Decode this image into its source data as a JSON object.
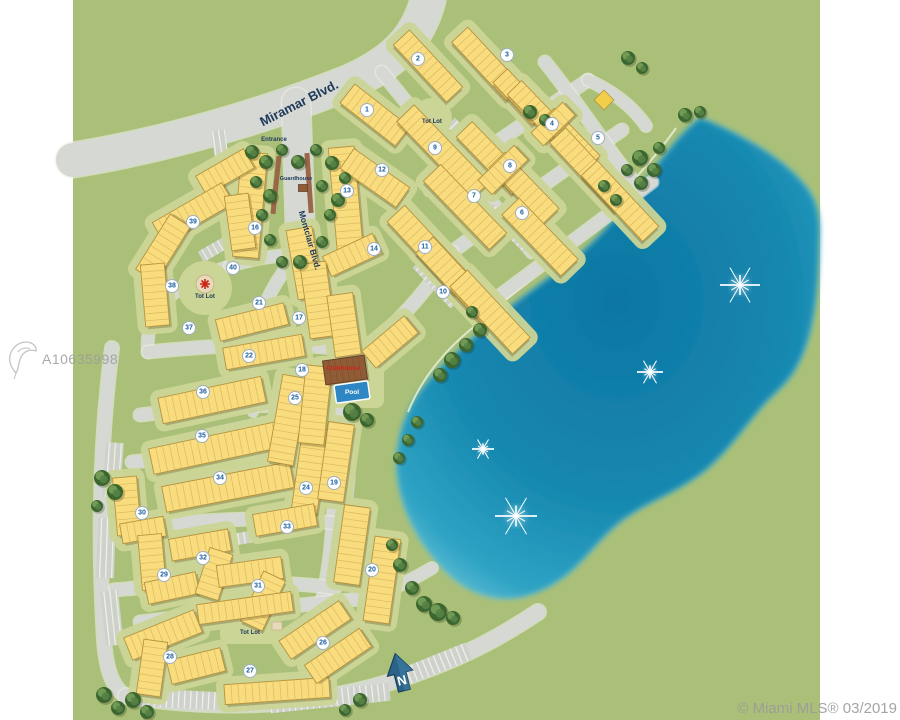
{
  "watermark": {
    "id": "A10635998"
  },
  "credit": {
    "text": "© Miami MLS® 03/2019"
  },
  "map": {
    "colors": {
      "white": "#ffffff",
      "green": "#aac079",
      "road": "#d6d8d3",
      "roadEdge": "#eceee8",
      "lawn": "#cbd596",
      "bldg": "#f9dc7e",
      "bldgLine": "#b5933e",
      "unitLine": "#dcba60",
      "shadow": "rgba(80,66,20,0.28)",
      "treeDark": "#3c662f",
      "treeMid": "#558247",
      "treeLight": "#7aa55b",
      "lakeDeep": "#0d76a3",
      "lakeMid": "#1c94ba",
      "lakeEdge": "#6ec6da",
      "shore": "#e9edd6",
      "badgeText": "#1a5fa0",
      "badgeRing": "#9fb0c0",
      "navy": "#203a5c",
      "red": "#cc2417",
      "median": "#9a6848",
      "club": "#8f5c36",
      "clubLine": "#66402a",
      "pool": "#2e86c4",
      "northBlue": "#2b6388",
      "northDark": "#173f5c",
      "diamond": "#f2cf4a",
      "comb": "#cfd2cc"
    },
    "frame": {
      "left": 73,
      "right": 820,
      "width": 900,
      "height": 720
    },
    "streets": [
      {
        "name": "Miramar Blvd.",
        "x": 301,
        "y": 107,
        "size": 13,
        "rotate": -27
      },
      {
        "name": "Montclair Blvd.",
        "x": 307,
        "y": 241,
        "size": 8.5,
        "rotate": 74
      }
    ],
    "labels": [
      {
        "key": "entrance",
        "text": "Entrance",
        "x": 274,
        "y": 141,
        "size": 6,
        "color": "navy"
      },
      {
        "key": "guardhouse",
        "text": "Guardhouse",
        "x": 296,
        "y": 180,
        "size": 5.5,
        "color": "navy"
      },
      {
        "key": "tot-lot-west",
        "text": "Tot Lot",
        "x": 205,
        "y": 298,
        "size": 6,
        "color": "navy"
      },
      {
        "key": "tot-lot-south",
        "text": "Tot Lot",
        "x": 250,
        "y": 634,
        "size": 6,
        "color": "navy"
      },
      {
        "key": "tot-lot-north",
        "text": "Tot Lot",
        "x": 432,
        "y": 123,
        "size": 6,
        "color": "navy"
      },
      {
        "key": "clubhouse",
        "text": "Clubhouse",
        "x": 343,
        "y": 370,
        "size": 6.5,
        "color": "red"
      },
      {
        "key": "pool",
        "text": "Pool",
        "x": 352,
        "y": 394,
        "size": 6.5,
        "color": "white"
      }
    ],
    "north": {
      "label": "N",
      "x": 401,
      "y": 677,
      "rotate": -14
    },
    "badges": [
      [
        1,
        367,
        110
      ],
      [
        2,
        418,
        59
      ],
      [
        3,
        507,
        55
      ],
      [
        4,
        552,
        124
      ],
      [
        5,
        598,
        138
      ],
      [
        6,
        522,
        213
      ],
      [
        7,
        474,
        196
      ],
      [
        8,
        510,
        166
      ],
      [
        9,
        435,
        148
      ],
      [
        10,
        443,
        292
      ],
      [
        11,
        425,
        247
      ],
      [
        12,
        382,
        170
      ],
      [
        13,
        347,
        191
      ],
      [
        14,
        374,
        249
      ],
      [
        16,
        255,
        228
      ],
      [
        17,
        299,
        318
      ],
      [
        18,
        302,
        370
      ],
      [
        19,
        334,
        483
      ],
      [
        20,
        372,
        570
      ],
      [
        21,
        259,
        303
      ],
      [
        22,
        249,
        356
      ],
      [
        24,
        306,
        488
      ],
      [
        25,
        295,
        398
      ],
      [
        26,
        323,
        643
      ],
      [
        27,
        250,
        671
      ],
      [
        28,
        170,
        657
      ],
      [
        29,
        164,
        575
      ],
      [
        30,
        142,
        513
      ],
      [
        31,
        258,
        586
      ],
      [
        32,
        203,
        558
      ],
      [
        33,
        287,
        527
      ],
      [
        34,
        220,
        478
      ],
      [
        35,
        202,
        436
      ],
      [
        36,
        203,
        392
      ],
      [
        37,
        189,
        328
      ],
      [
        38,
        172,
        286
      ],
      [
        39,
        193,
        222
      ],
      [
        40,
        233,
        268
      ]
    ],
    "fountains": [
      [
        740,
        285,
        40
      ],
      [
        650,
        372,
        26
      ],
      [
        483,
        449,
        22
      ],
      [
        516,
        516,
        42
      ]
    ],
    "lake_path": "M 700,118 C 735,132 772,152 795,175 C 812,192 820,205 819,235 C 818,280 816,318 804,350 C 792,382 776,390 762,406 C 740,432 722,458 700,474 C 672,494 652,500 634,512 C 610,526 596,546 578,564 C 558,584 532,598 505,598 C 478,597 456,584 436,560 C 416,536 402,508 398,478 C 395,452 400,424 416,398 C 434,370 462,348 492,322 C 520,298 550,278 578,256 C 602,236 626,206 646,180 C 660,162 676,138 700,118 Z",
    "shore_path": "M 676,128 C 648,168 610,205 575,242 C 540,272 505,300 470,330 C 440,355 420,382 408,412",
    "roads": [
      [
        "M 73,160 C 160,146 260,118 350,82 C 395,62 418,38 428,0",
        34
      ],
      [
        "M 296,102 L 301,252",
        28
      ],
      [
        "M 300,252 C 315,300 330,332 352,358",
        15
      ],
      [
        "M 352,358 C 344,410 338,470 334,520 C 332,560 326,600 312,642",
        14
      ],
      [
        "M 298,254 C 272,282 258,314 252,350",
        11
      ],
      [
        "M 230,266 C 200,276 178,288 166,300 C 152,314 146,332 148,352",
        11
      ],
      [
        "M 230,266 C 252,259 272,256 298,254",
        11
      ],
      [
        "M 148,352 C 240,343 300,342 356,351",
        12
      ],
      [
        "M 140,415 C 230,404 300,402 352,410",
        12
      ],
      [
        "M 132,462 C 225,452 300,450 348,458",
        12
      ],
      [
        "M 122,528 C 215,518 290,516 340,524",
        12
      ],
      [
        "M 114,590 C 200,582 280,580 335,588",
        12
      ],
      [
        "M 112,348 C 100,440 98,540 104,640 C 106,668 112,688 126,696",
        13
      ],
      [
        "M 126,696 C 230,712 330,706 420,672 C 470,654 505,634 538,612",
        15
      ],
      [
        "M 140,622 C 220,612 300,606 368,598",
        12
      ],
      [
        "M 252,350 C 252,380 252,396 253,412",
        9
      ],
      [
        "M 430,190 C 480,152 545,110 588,80",
        12
      ],
      [
        "M 452,252 C 515,205 575,162 622,130",
        12
      ],
      [
        "M 478,312 C 545,262 612,212 652,182",
        12
      ],
      [
        "M 420,122 C 458,162 495,205 532,252",
        12
      ],
      [
        "M 545,62 C 572,95 600,138 632,180",
        12
      ],
      [
        "M 382,72 C 400,95 412,108 420,122",
        12
      ],
      [
        "M 352,358 C 394,330 426,292 452,252",
        12
      ],
      [
        "M 588,80 C 614,92 634,108 646,126",
        11
      ],
      [
        "M 368,598 C 392,590 412,580 432,568",
        11
      ]
    ],
    "combs": [
      [
        113,
        470,
        18,
        55,
        4
      ],
      [
        106,
        548,
        18,
        60,
        2
      ],
      [
        112,
        618,
        18,
        55,
        -6
      ],
      [
        196,
        700,
        110,
        18,
        3
      ],
      [
        330,
        698,
        120,
        18,
        -6
      ],
      [
        436,
        664,
        70,
        18,
        -22
      ],
      [
        250,
        425,
        80,
        12,
        -12
      ],
      [
        240,
        473,
        80,
        12,
        -11
      ],
      [
        232,
        540,
        70,
        12,
        -10
      ],
      [
        302,
        440,
        12,
        60,
        8
      ],
      [
        347,
        502,
        12,
        55,
        6
      ],
      [
        470,
        142,
        56,
        12,
        46
      ],
      [
        508,
        228,
        56,
        12,
        46
      ],
      [
        436,
        284,
        56,
        12,
        47
      ],
      [
        225,
        243,
        56,
        12,
        -30
      ],
      [
        222,
        160,
        14,
        60,
        -8
      ]
    ],
    "buildings": [
      [
        250,
        205,
        26,
        105,
        5
      ],
      [
        346,
        202,
        26,
        110,
        -5
      ],
      [
        225,
        172,
        55,
        22,
        -30
      ],
      [
        193,
        213,
        80,
        24,
        -30
      ],
      [
        163,
        248,
        65,
        24,
        -58
      ],
      [
        155,
        295,
        24,
        62,
        -5
      ],
      [
        240,
        222,
        24,
        55,
        -8
      ],
      [
        305,
        263,
        26,
        70,
        -10
      ],
      [
        252,
        322,
        70,
        22,
        -14
      ],
      [
        264,
        352,
        80,
        22,
        -10
      ],
      [
        352,
        255,
        55,
        22,
        -25
      ],
      [
        318,
        300,
        26,
        75,
        -8
      ],
      [
        344,
        325,
        26,
        62,
        -8
      ],
      [
        375,
        115,
        70,
        24,
        38
      ],
      [
        428,
        66,
        78,
        22,
        47
      ],
      [
        487,
        64,
        80,
        22,
        47
      ],
      [
        520,
        97,
        58,
        20,
        47
      ],
      [
        443,
        152,
        108,
        24,
        46
      ],
      [
        492,
        158,
        80,
        22,
        46
      ],
      [
        524,
        188,
        78,
        22,
        46
      ],
      [
        503,
        170,
        50,
        20,
        -44
      ],
      [
        538,
        112,
        68,
        20,
        46
      ],
      [
        570,
        139,
        66,
        20,
        46
      ],
      [
        553,
        124,
        44,
        18,
        -44
      ],
      [
        590,
        170,
        95,
        22,
        47
      ],
      [
        620,
        201,
        90,
        22,
        47
      ],
      [
        465,
        207,
        95,
        24,
        46
      ],
      [
        540,
        237,
        85,
        24,
        46
      ],
      [
        430,
        250,
        100,
        24,
        47
      ],
      [
        458,
        281,
        98,
        24,
        47
      ],
      [
        490,
        312,
        92,
        24,
        47
      ],
      [
        375,
        178,
        68,
        24,
        35
      ],
      [
        212,
        400,
        105,
        26,
        -12
      ],
      [
        215,
        448,
        130,
        26,
        -12
      ],
      [
        228,
        487,
        130,
        26,
        -11
      ],
      [
        288,
        420,
        26,
        88,
        10
      ],
      [
        310,
        470,
        26,
        85,
        8
      ],
      [
        336,
        462,
        26,
        78,
        8
      ],
      [
        285,
        520,
        62,
        22,
        -10
      ],
      [
        127,
        506,
        24,
        58,
        -5
      ],
      [
        143,
        530,
        44,
        20,
        -10
      ],
      [
        152,
        562,
        24,
        55,
        -5
      ],
      [
        172,
        588,
        52,
        22,
        -12
      ],
      [
        200,
        545,
        60,
        22,
        -10
      ],
      [
        214,
        574,
        24,
        48,
        18
      ],
      [
        250,
        572,
        65,
        22,
        -8
      ],
      [
        263,
        601,
        24,
        55,
        25
      ],
      [
        163,
        635,
        75,
        24,
        -22
      ],
      [
        152,
        668,
        24,
        55,
        8
      ],
      [
        196,
        666,
        55,
        24,
        -14
      ],
      [
        277,
        691,
        105,
        20,
        -4
      ],
      [
        315,
        630,
        72,
        22,
        -34
      ],
      [
        338,
        656,
        66,
        22,
        -34
      ],
      [
        382,
        580,
        26,
        85,
        8
      ],
      [
        352,
        545,
        26,
        78,
        8
      ],
      [
        245,
        608,
        95,
        20,
        -8
      ],
      [
        315,
        405,
        26,
        78,
        6
      ],
      [
        390,
        342,
        55,
        22,
        -40
      ]
    ],
    "trees": [
      [
        252,
        152,
        7
      ],
      [
        266,
        162,
        7
      ],
      [
        282,
        150,
        6
      ],
      [
        298,
        162,
        7
      ],
      [
        316,
        150,
        6
      ],
      [
        332,
        163,
        7
      ],
      [
        345,
        178,
        6
      ],
      [
        256,
        182,
        6
      ],
      [
        270,
        196,
        7
      ],
      [
        322,
        186,
        6
      ],
      [
        338,
        200,
        7
      ],
      [
        262,
        215,
        6
      ],
      [
        330,
        215,
        6
      ],
      [
        270,
        240,
        6
      ],
      [
        322,
        242,
        6
      ],
      [
        300,
        262,
        7
      ],
      [
        282,
        262,
        6
      ],
      [
        530,
        112,
        7
      ],
      [
        545,
        120,
        6
      ],
      [
        628,
        58,
        7
      ],
      [
        642,
        68,
        6
      ],
      [
        685,
        115,
        7
      ],
      [
        700,
        112,
        6
      ],
      [
        640,
        158,
        8
      ],
      [
        654,
        170,
        7
      ],
      [
        641,
        183,
        7
      ],
      [
        627,
        170,
        6
      ],
      [
        659,
        148,
        6
      ],
      [
        604,
        186,
        6
      ],
      [
        616,
        200,
        6
      ],
      [
        480,
        330,
        7
      ],
      [
        466,
        345,
        7
      ],
      [
        452,
        360,
        8
      ],
      [
        440,
        375,
        7
      ],
      [
        472,
        312,
        6
      ],
      [
        408,
        440,
        6
      ],
      [
        399,
        458,
        6
      ],
      [
        417,
        422,
        6
      ],
      [
        392,
        545,
        6
      ],
      [
        400,
        565,
        7
      ],
      [
        412,
        588,
        7
      ],
      [
        424,
        604,
        8
      ],
      [
        438,
        612,
        9
      ],
      [
        453,
        618,
        7
      ],
      [
        102,
        478,
        8
      ],
      [
        115,
        492,
        8
      ],
      [
        97,
        506,
        6
      ],
      [
        104,
        695,
        8
      ],
      [
        118,
        708,
        7
      ],
      [
        133,
        700,
        8
      ],
      [
        147,
        712,
        7
      ],
      [
        360,
        700,
        7
      ],
      [
        345,
        710,
        6
      ],
      [
        352,
        412,
        9
      ],
      [
        367,
        420,
        7
      ]
    ],
    "medians": [
      [
        276,
        185,
        5,
        58,
        6
      ],
      [
        309,
        183,
        5,
        60,
        -4
      ]
    ],
    "amenities": {
      "guardhouse_rect": [
        303,
        188,
        9,
        7
      ],
      "clubhouse_rect": [
        345,
        370,
        42,
        24,
        -8
      ],
      "pool_rect": [
        352,
        392,
        34,
        18,
        -8
      ],
      "diamond": [
        604,
        100,
        14,
        45
      ],
      "totlot_west_circle": [
        205,
        284,
        9
      ],
      "totlot_south_square": [
        277,
        626,
        10,
        8
      ]
    }
  }
}
